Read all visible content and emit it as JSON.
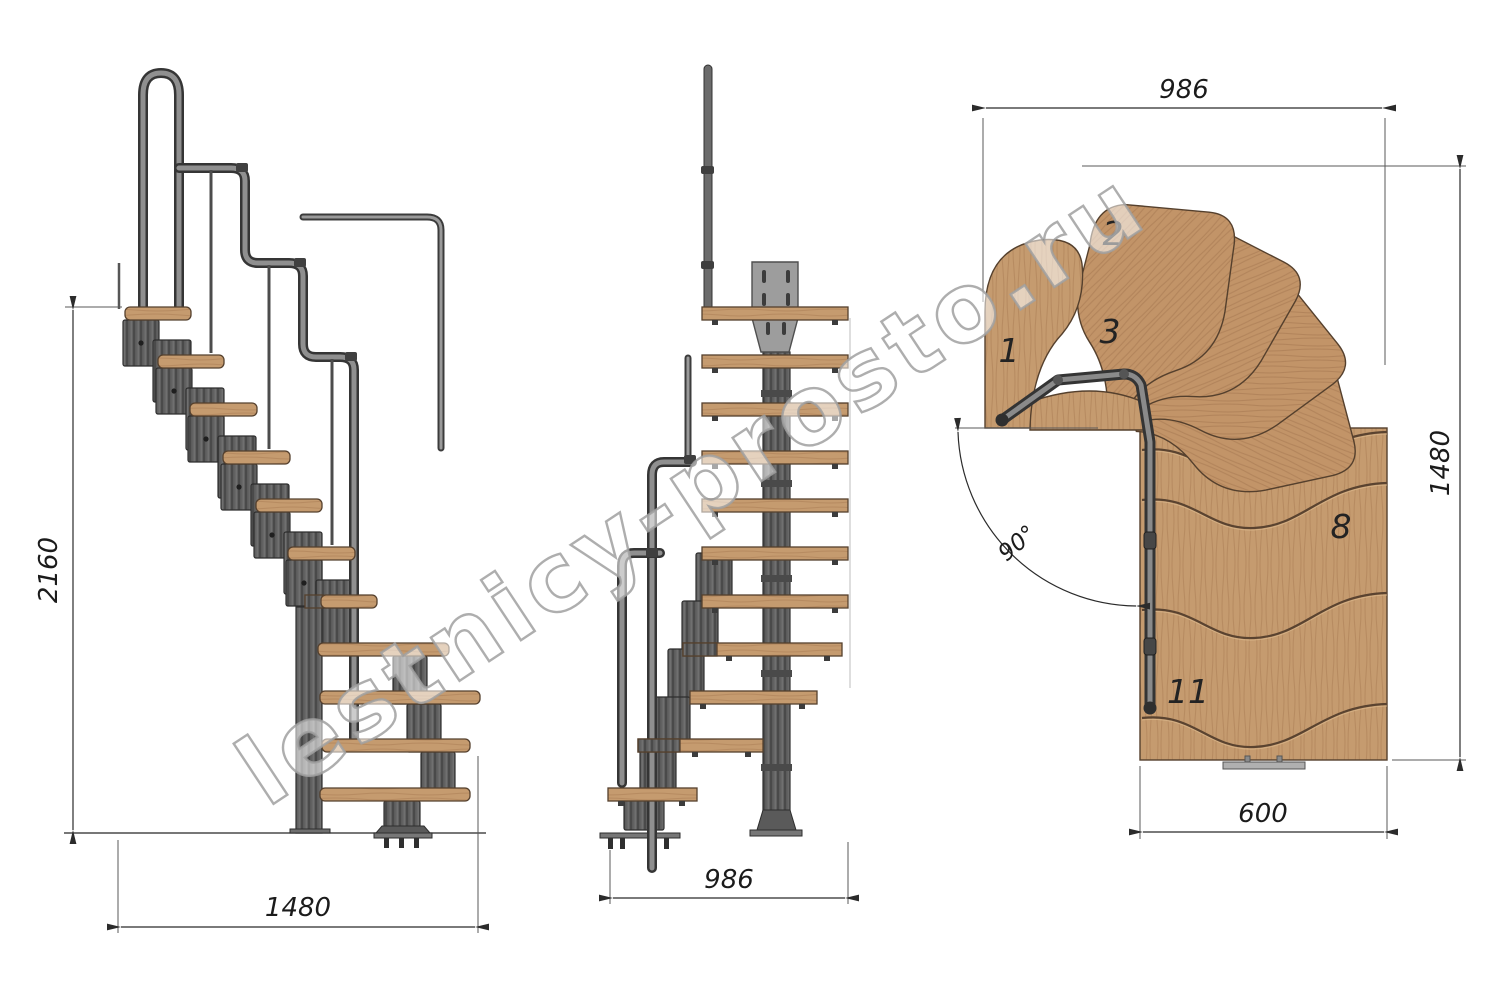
{
  "watermark": {
    "text": "lestnicy-prosto.ru"
  },
  "colors": {
    "background": "#ffffff",
    "wood": "#c59b6f",
    "wood_streak": "#b1855b",
    "wood_outline": "#55402d",
    "metal": "#616161",
    "metal_dark": "#3a3a3a",
    "plate_gray": "#9d9d9d",
    "dimension_line": "#2b2b2b",
    "text": "#1b1b1b"
  },
  "side_view": {
    "height_dim": "2160",
    "width_dim": "1480"
  },
  "front_view": {
    "width_dim": "986"
  },
  "plan_view": {
    "top_dim": "986",
    "right_dim": "1480",
    "bottom_dim": "600",
    "angle_dim": "90°",
    "labels": [
      {
        "text": "1"
      },
      {
        "text": "2"
      },
      {
        "text": "3"
      },
      {
        "text": "8"
      },
      {
        "text": "11"
      }
    ]
  }
}
